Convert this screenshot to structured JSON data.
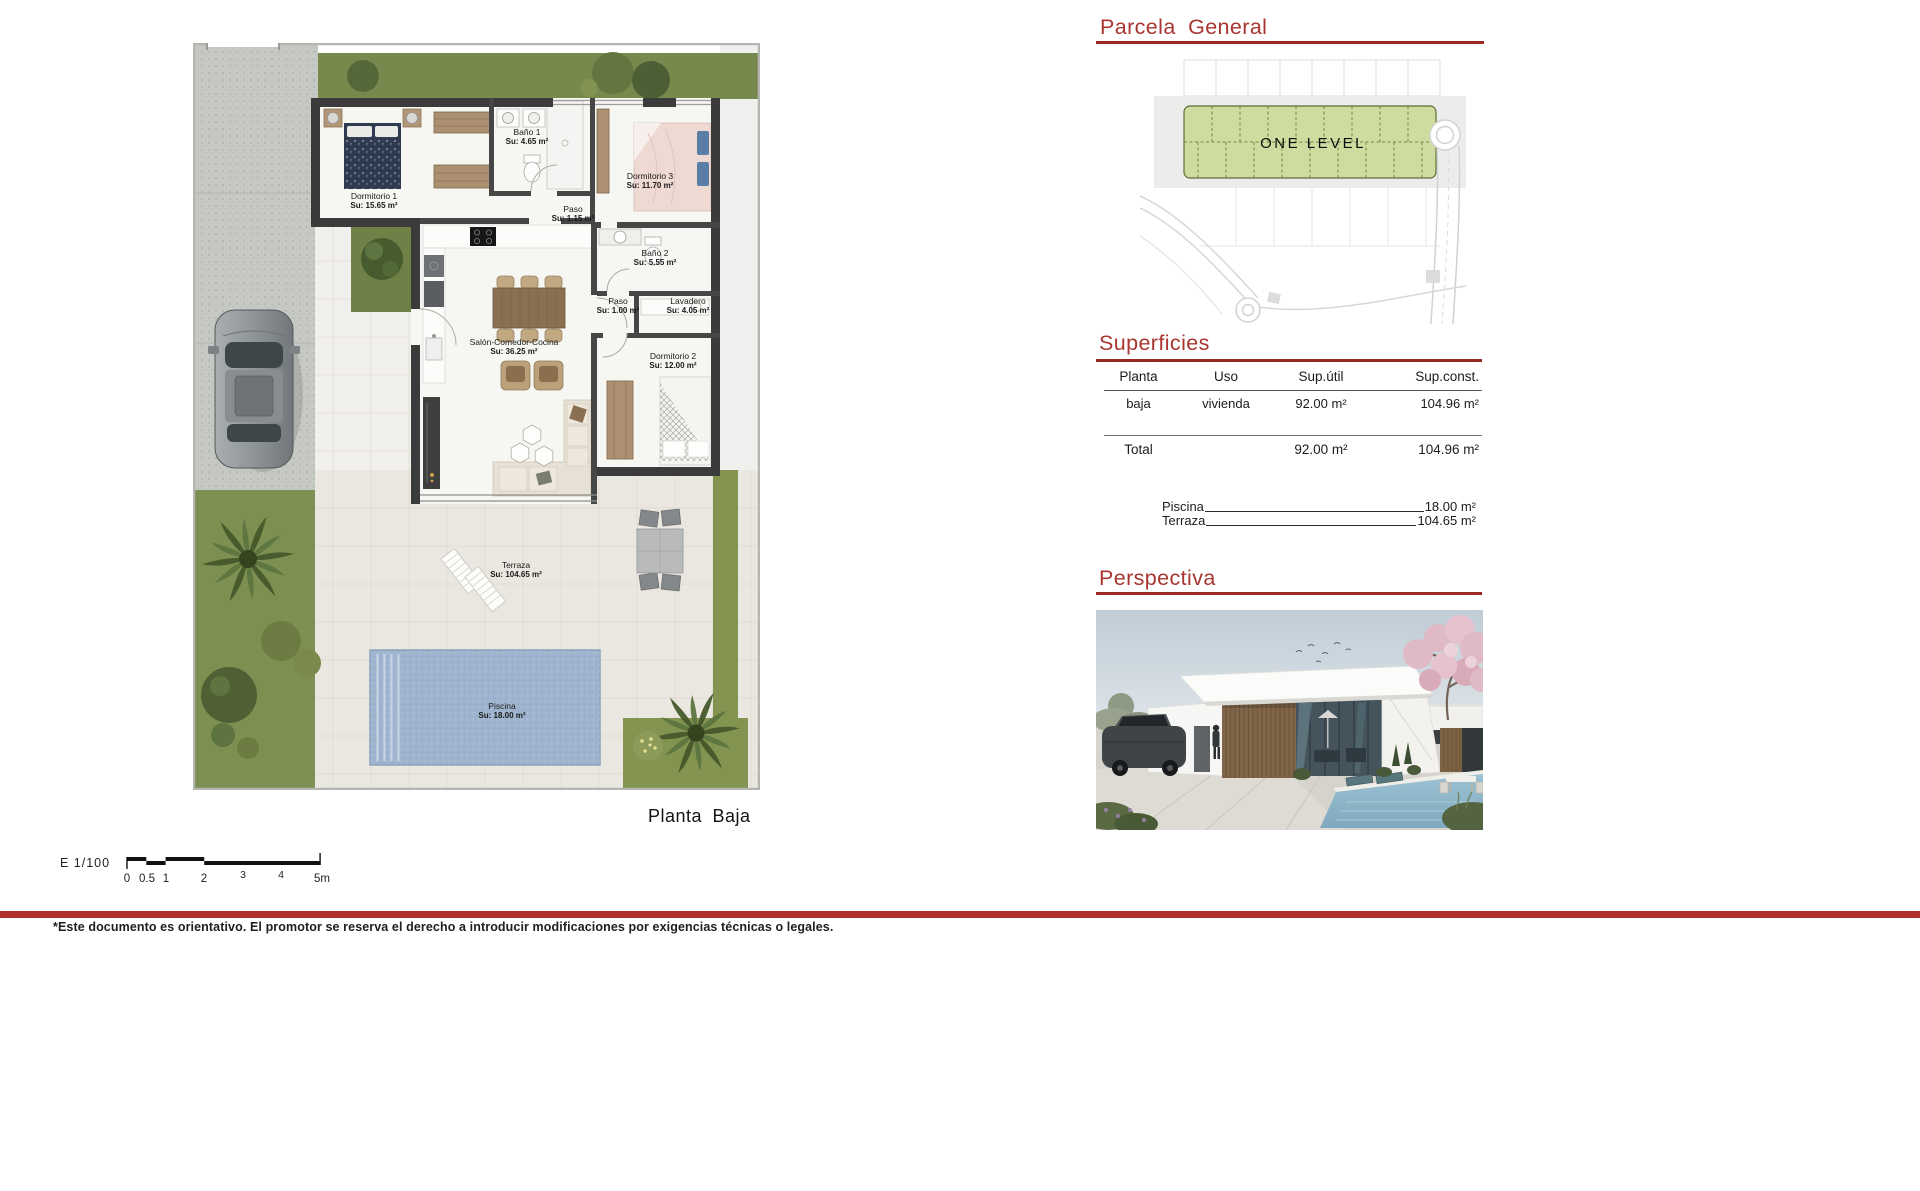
{
  "document": {
    "plan_caption": "Planta Baja",
    "scale_label": "E 1/100",
    "scale_ticks": [
      "0",
      "0.5",
      "1",
      "2",
      "3",
      "4",
      "5m"
    ],
    "footnote": "*Este documento es orientativo. El promotor se reserva el derecho a introducir modificaciones por exigencias técnicas o legales."
  },
  "floorplan": {
    "rooms": {
      "dormitorio1": {
        "name": "Dormitorio 1",
        "area": "Su: 15.65 m²"
      },
      "bano1": {
        "name": "Baño 1",
        "area": "Su: 4.65 m²"
      },
      "dormitorio3": {
        "name": "Dormitorio 3",
        "area": "Su: 11.70 m²"
      },
      "paso1": {
        "name": "Paso",
        "area": "Su: 1.15 m²"
      },
      "bano2": {
        "name": "Baño 2",
        "area": "Su: 5.55 m²"
      },
      "paso2": {
        "name": "Paso",
        "area": "Su: 1.00 m²"
      },
      "lavadero": {
        "name": "Lavadero",
        "area": "Su: 4.05 m²"
      },
      "salon": {
        "name": "Salón-Comedor-Cocina",
        "area": "Su: 36.25 m²"
      },
      "dormitorio2": {
        "name": "Dormitorio 2",
        "area": "Su: 12.00 m²"
      },
      "terraza": {
        "name": "Terraza",
        "area": "Su: 104.65 m²"
      },
      "piscina": {
        "name": "Piscina",
        "area": "Su: 18.00 m²"
      }
    }
  },
  "parcela": {
    "title": "Parcela General",
    "plot_label": "ONE LEVEL"
  },
  "superficies": {
    "title": "Superficies",
    "columns": [
      "Planta",
      "Uso",
      "Sup.útil",
      "Sup.const."
    ],
    "rows": [
      [
        "baja",
        "vivienda",
        "92.00 m²",
        "104.96 m²"
      ]
    ],
    "total": {
      "label": "Total",
      "util": "92.00 m²",
      "const": "104.96 m²"
    },
    "extras": [
      {
        "label": "Piscina",
        "value": "18.00 m²"
      },
      {
        "label": "Terraza",
        "value": "104.65 m²"
      }
    ]
  },
  "perspectiva": {
    "title": "Perspectiva"
  },
  "colors": {
    "accent_red": "#a93531",
    "rule_red": "#9c2823",
    "footer_bar_red": "#b0302b",
    "parcela_green": "#cedd9f",
    "grass_green": "#7d9052",
    "pool_blue": "#9fb5cf",
    "wall_dark": "#3b3b3b"
  }
}
